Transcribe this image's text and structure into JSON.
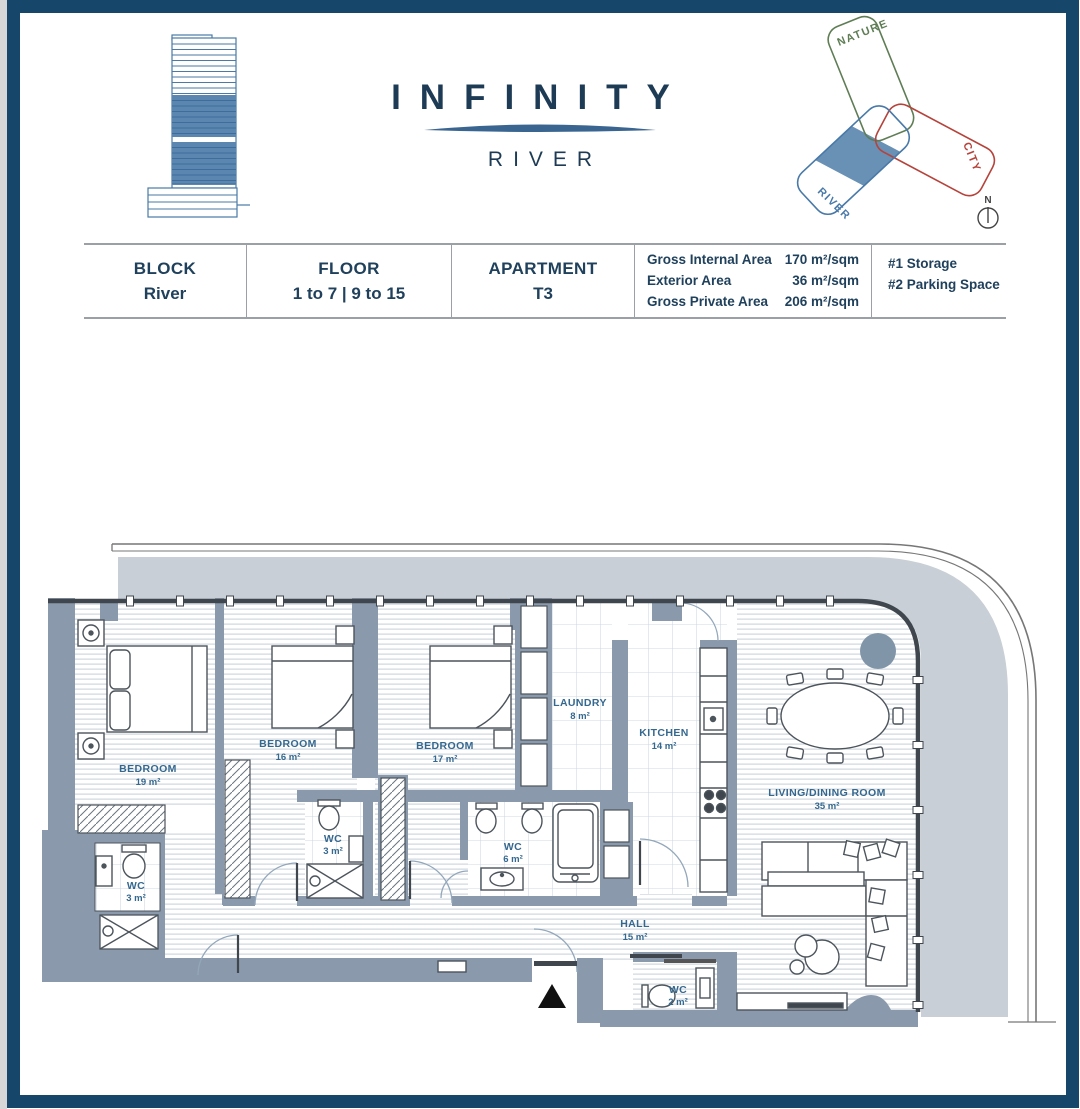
{
  "brand": {
    "title": "INFINITY",
    "subtitle": "RIVER"
  },
  "site_diagram": {
    "nature": "NATURE",
    "city": "CITY",
    "river": "RIVER",
    "compass_n": "N",
    "colors": {
      "nature": "#5f7d55",
      "city": "#b5433b",
      "river": "#4879a8",
      "highlight_fill": "#6990b5"
    }
  },
  "info_table": {
    "columns": [
      {
        "label": "BLOCK",
        "value": "River"
      },
      {
        "label": "FLOOR",
        "value": "1 to 7 | 9 to 15"
      },
      {
        "label": "APARTMENT",
        "value": "T3"
      }
    ],
    "areas": [
      {
        "label": "Gross Internal Area",
        "value": "170 m²/sqm"
      },
      {
        "label": "Exterior Area",
        "value": "36 m²/sqm"
      },
      {
        "label": "Gross Private Area",
        "value": "206 m²/sqm"
      }
    ],
    "extras": [
      {
        "label": "#1 Storage"
      },
      {
        "label": "#2 Parking Space"
      }
    ]
  },
  "floor_plan": {
    "rooms": [
      {
        "name": "BEDROOM",
        "area": "19 m²"
      },
      {
        "name": "BEDROOM",
        "area": "16 m²"
      },
      {
        "name": "BEDROOM",
        "area": "17 m²"
      },
      {
        "name": "LAUNDRY",
        "area": "8 m²"
      },
      {
        "name": "KITCHEN",
        "area": "14 m²"
      },
      {
        "name": "LIVING/DINING ROOM",
        "area": "35 m²"
      },
      {
        "name": "WC",
        "area": "3 m²"
      },
      {
        "name": "WC",
        "area": "3 m²"
      },
      {
        "name": "WC",
        "area": "6 m²"
      },
      {
        "name": "HALL",
        "area": "15 m²"
      },
      {
        "name": "WC",
        "area": "2 m²"
      }
    ],
    "colors": {
      "wall": "#8a99ab",
      "balcony": "#c9cfd6",
      "label": "#35688f",
      "window_line": "#3f464d"
    }
  }
}
